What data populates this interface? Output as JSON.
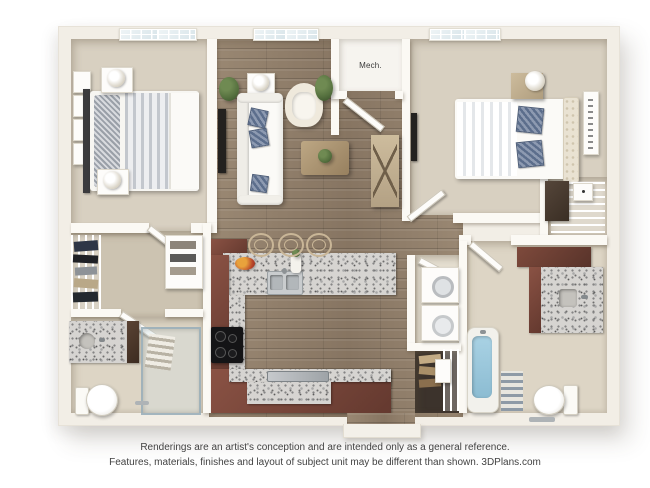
{
  "plan": {
    "labels": {
      "mech": "Mech."
    },
    "colors": {
      "bg": "#ffffff",
      "wall": "#f2eee6",
      "wall_bright": "#fbf9f4",
      "carpet": "#d8d0c1",
      "carpet_dark": "#ccc3b1",
      "wood": "#9a8873",
      "wood_dark": "#877562",
      "tile": "#ddd5c5",
      "tile2": "#e6e0d2",
      "granite": "#d6d4d1",
      "cabinet": "#8a5244",
      "cabinet_dark": "#64392f",
      "dark_wood": "#3c332c",
      "navy": "#5c6e8c",
      "water": "#a9d2e4",
      "plant": "#56713f",
      "metal": "#aeb3b6",
      "glass": "#dbe8ec",
      "stool": "#c9b697",
      "text": "#424242"
    }
  },
  "footer": {
    "line1": "Renderings are an artist's conception and are intended only as a general reference.",
    "line2": "Features, materials, finishes and layout of subject unit may be different than shown. 3DPlans.com"
  }
}
